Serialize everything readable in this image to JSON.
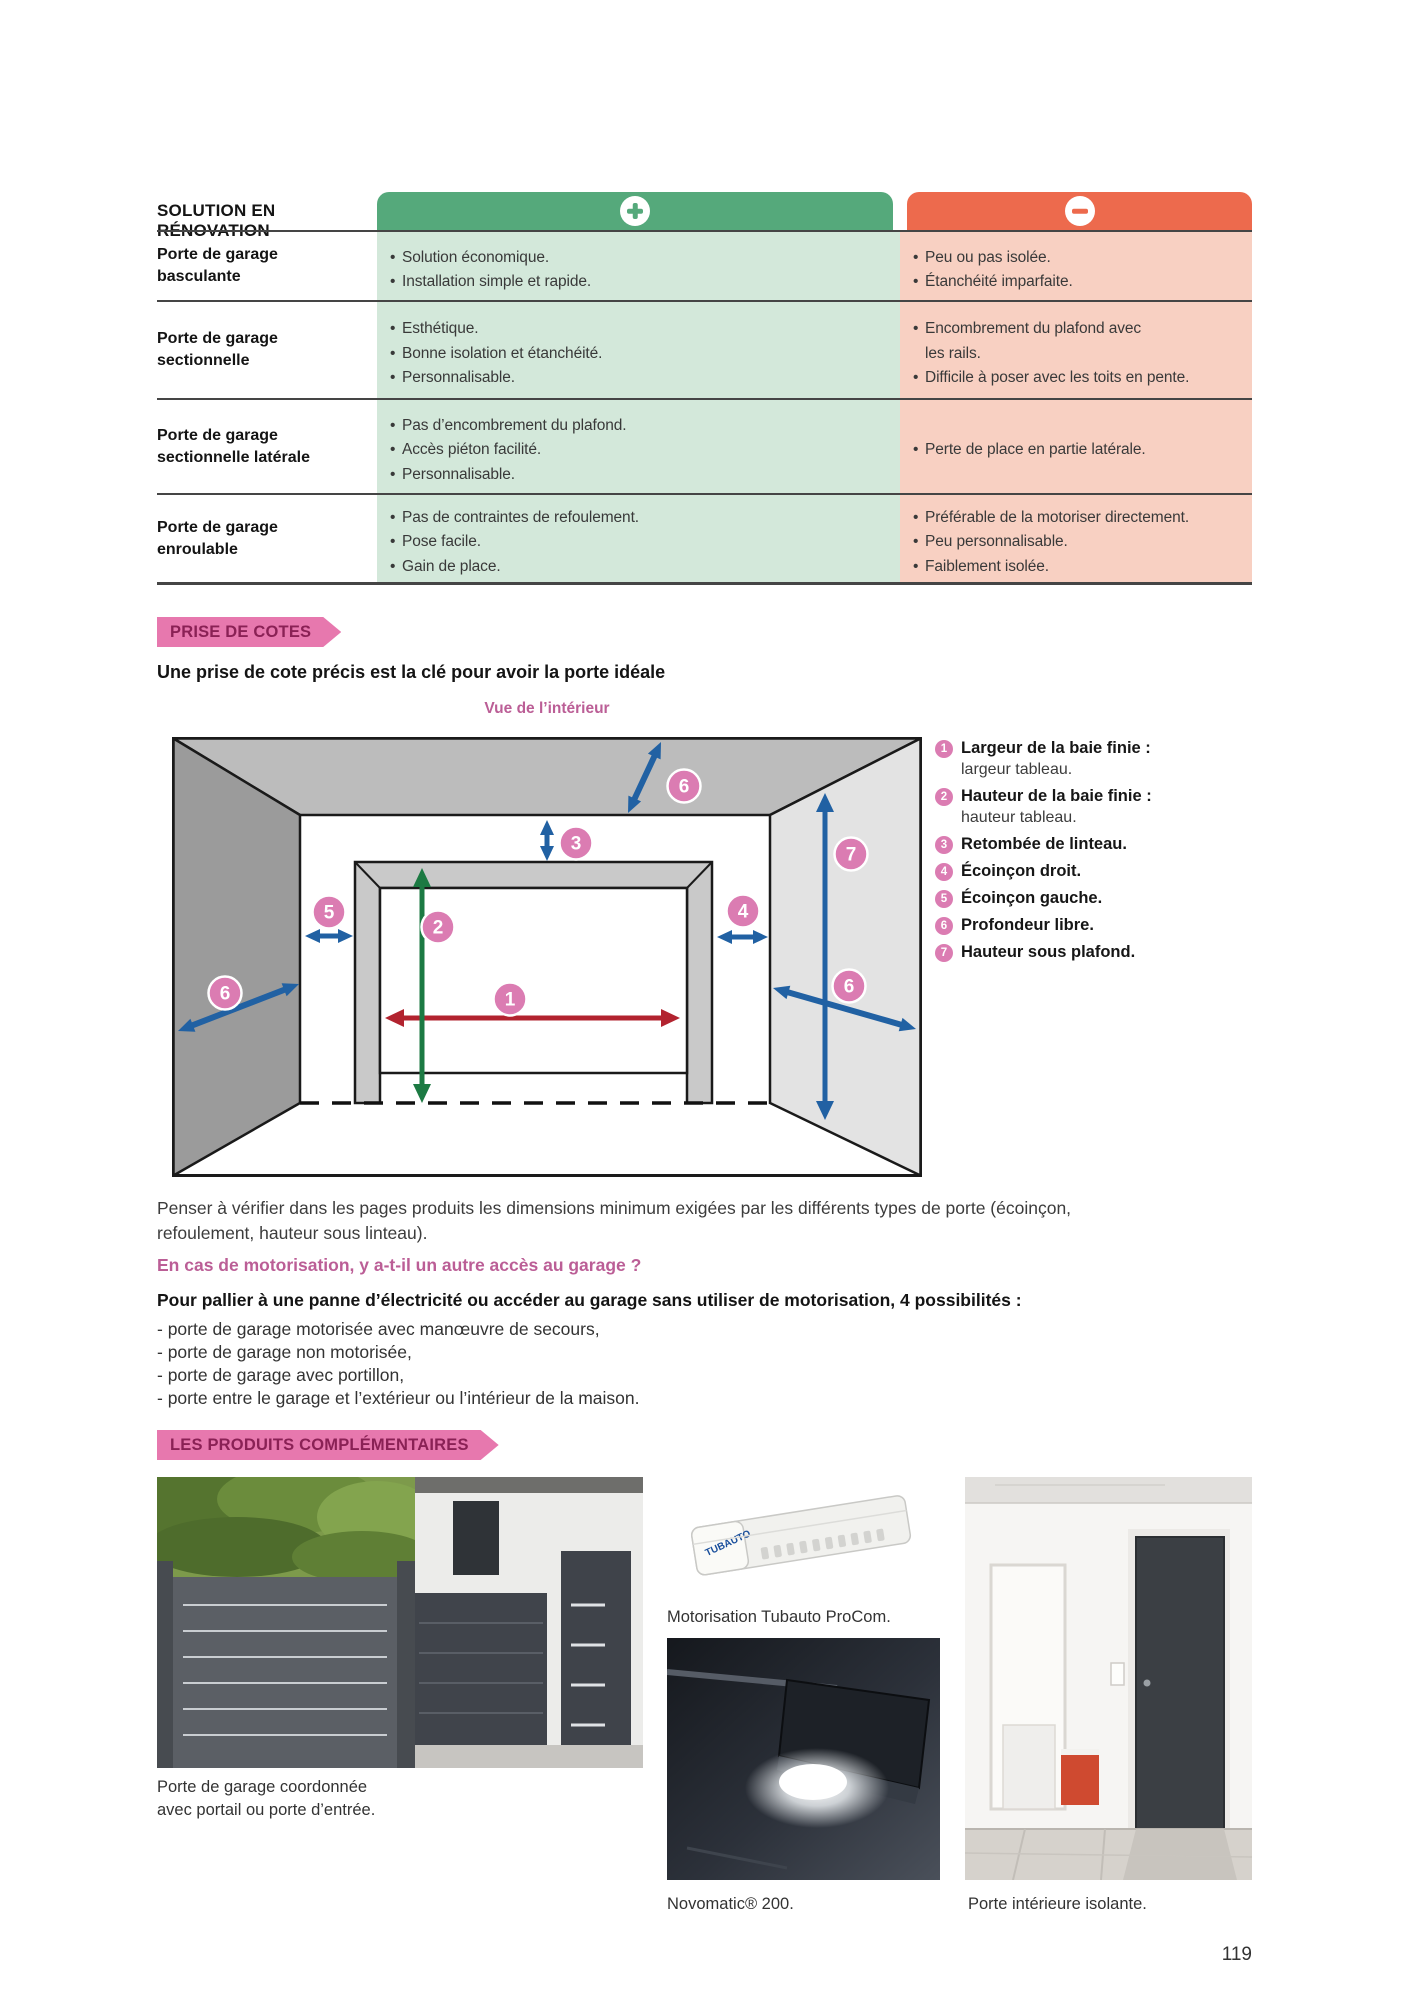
{
  "table": {
    "title": "SOLUTION EN RÉNOVATION",
    "rows": [
      {
        "label": "Porte de garage\nbasculante",
        "pros": [
          "Solution économique.",
          "Installation simple et rapide."
        ],
        "cons": [
          "Peu ou pas isolée.",
          "Étanchéité imparfaite."
        ]
      },
      {
        "label": "Porte de garage\nsectionnelle",
        "pros": [
          "Esthétique.",
          "Bonne isolation et étanchéité.",
          "Personnalisable."
        ],
        "cons": [
          "Encombrement du plafond avec\nles rails.",
          "Difficile à poser avec les toits en pente."
        ]
      },
      {
        "label": "Porte de garage\nsectionnelle latérale",
        "pros": [
          "Pas d’encombrement du plafond.",
          "Accès piéton facilité.",
          "Personnalisable."
        ],
        "cons": [
          "Perte de place en partie latérale."
        ]
      },
      {
        "label": "Porte de garage\nenroulable",
        "pros": [
          "Pas de contraintes de refoulement.",
          "Pose facile.",
          "Gain de place."
        ],
        "cons": [
          "Préférable de la motoriser directement.",
          "Peu personnalisable.",
          "Faiblement isolée."
        ]
      }
    ]
  },
  "prise": {
    "banner": "PRISE DE COTES",
    "headline": "Une prise de cote précis est la clé pour avoir la porte idéale",
    "view_label": "Vue de l’intérieur"
  },
  "diagram": {
    "markers": {
      "m1": "1",
      "m2": "2",
      "m3": "3",
      "m4": "4",
      "m5": "5",
      "m6": "6",
      "m7": "7"
    }
  },
  "legend": {
    "items": [
      {
        "n": "1",
        "t": "Largeur de la baie finie :",
        "s": "largeur tableau."
      },
      {
        "n": "2",
        "t": "Hauteur de la baie finie :",
        "s": "hauteur tableau."
      },
      {
        "n": "3",
        "t": "Retombée de linteau."
      },
      {
        "n": "4",
        "t": "Écoinçon droit."
      },
      {
        "n": "5",
        "t": "Écoinçon gauche."
      },
      {
        "n": "6",
        "t": "Profondeur libre."
      },
      {
        "n": "7",
        "t": "Hauteur sous plafond."
      }
    ]
  },
  "notes": {
    "dimension_note": "Penser à vérifier dans les pages produits les dimensions minimum exigées par les différents types de porte (écoinçon,\nrefoulement, hauteur sous linteau).",
    "question": "En cas de motorisation, y a-t-il un autre accès au garage ?",
    "intro": "Pour pallier à une panne d’électricité ou accéder au garage sans utiliser de motorisation, 4 possibilités :",
    "options": [
      "- porte de garage motorisée avec manœuvre de secours,",
      "- porte de garage non motorisée,",
      "- porte de garage avec portillon,",
      "- porte entre le garage et l’extérieur ou l’intérieur de la maison."
    ]
  },
  "produits": {
    "banner": "LES PRODUITS COMPLÉMENTAIRES",
    "tubauto_brand": "TUBAUTO",
    "captions": {
      "portail": "Porte de garage coordonnée\navec portail ou porte d’entrée.",
      "tubauto": "Motorisation Tubauto ProCom.",
      "novomatic": "Novomatic® 200.",
      "porte_interieure": "Porte intérieure isolante."
    }
  },
  "page_number": "119",
  "colors": {
    "green_header": "#55a97b",
    "green_body": "#d3e8da",
    "orange_header": "#ed6a4d",
    "orange_body": "#f8d0c2",
    "banner_pink": "#e778ae",
    "banner_text": "#8a2155",
    "accent_pink": "#bb5e96",
    "marker_pink": "#db7cb2",
    "arrow_blue": "#2161a3",
    "arrow_red": "#b2232f",
    "arrow_green": "#1c7a43"
  }
}
